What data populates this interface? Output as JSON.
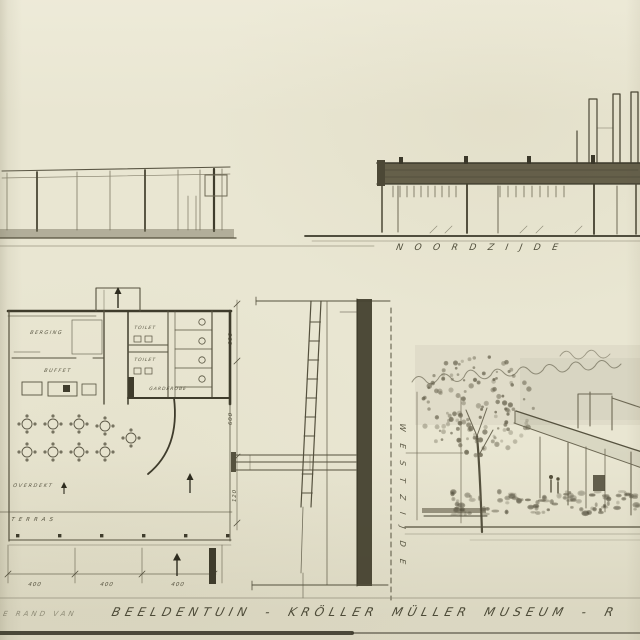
{
  "caption": {
    "prefix": "E RAND VAN",
    "main": "BEELDENTUIN - KRÖLLER MÜLLER MUSEUM - R"
  },
  "elevation_north": {
    "label": "NOORDZIJDE"
  },
  "section": {
    "side_label": "WESTZIJDE"
  },
  "plan": {
    "rooms": {
      "storage": "BERGING",
      "buffet": "BUFFET",
      "toilet_upper": "TOILET",
      "toilet_lower": "TOILET",
      "cloakroom": "GARDEROBE",
      "covered": "OVERDEKT",
      "terrace": "TERRAS"
    },
    "dims_bottom": [
      "400",
      "400",
      "400"
    ],
    "dims_right": [
      "600",
      "600",
      "120"
    ]
  },
  "colors": {
    "paper": "#e9e6d2",
    "ink_dark": "#3e3b2a",
    "pencil": "#8a8571",
    "roof_wash": "#57513c"
  }
}
